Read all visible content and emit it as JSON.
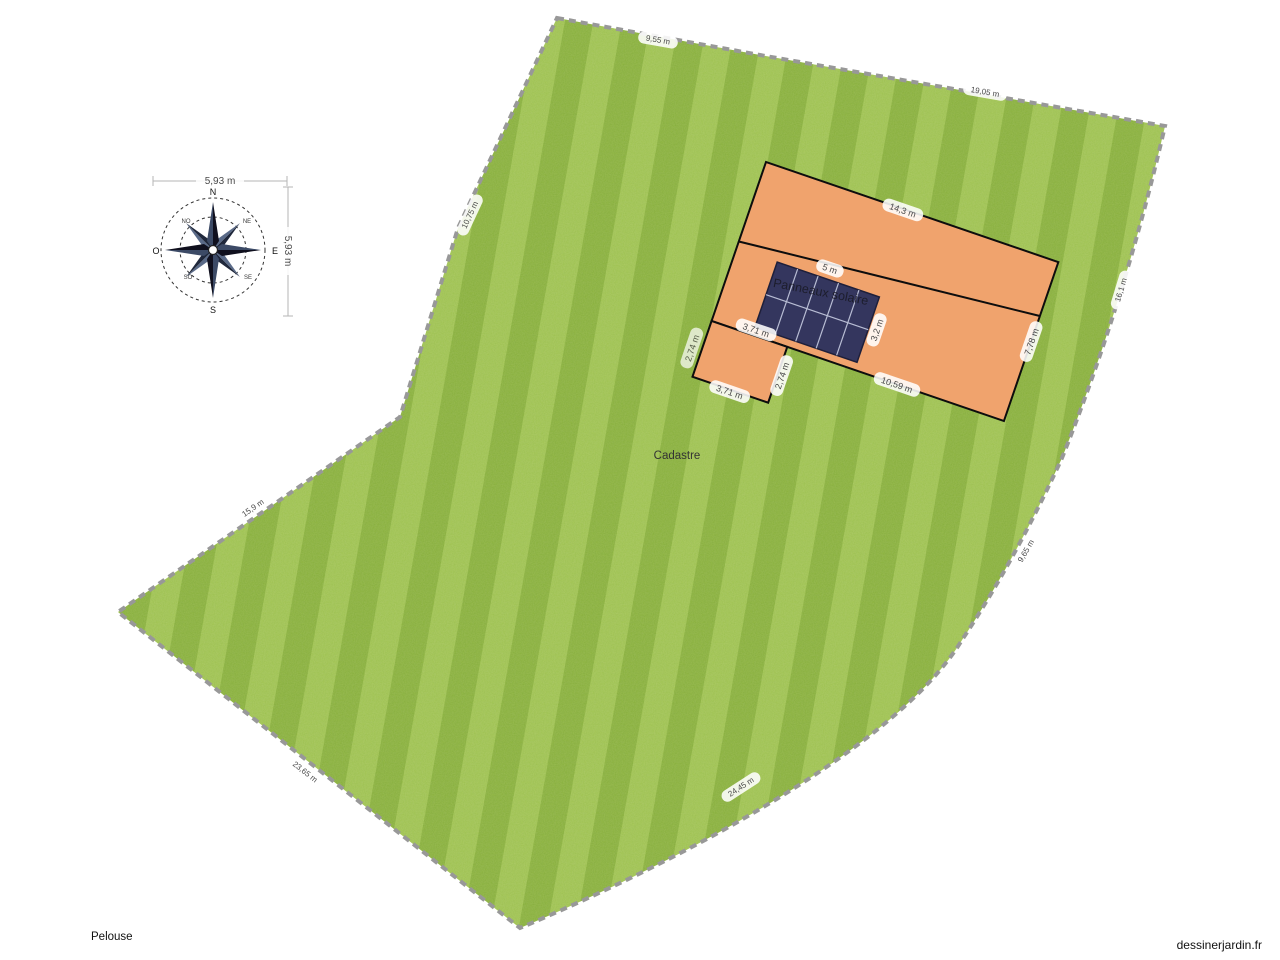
{
  "watermark": {
    "text": "dessinerjardin.fr"
  },
  "labels": {
    "lawn_name": "Pelouse",
    "cadastre": "Cadastre"
  },
  "colors": {
    "lawn_green": "#8eb83c",
    "building_orange": "#f0a36d",
    "panel_navy": "#34365e",
    "panel_grid": "#b8bdd4",
    "outline_black": "#0d0d0d",
    "dashed_border_gray": "#989898",
    "dim_text_gray": "#4a4a4a"
  },
  "compass": {
    "cardinal": {
      "n": "N",
      "s": "S",
      "e": "E",
      "o": "O"
    },
    "intercardinal": {
      "no": "NO",
      "ne": "NE",
      "so": "SO",
      "se": "SE"
    },
    "dim_top": "5,93 m",
    "dim_right": "5,93 m"
  },
  "building": {
    "dims": {
      "top": "14,3 m",
      "bottom": "10,59 m",
      "right": "7,78 m",
      "ext_top": "3,71 m",
      "ext_right": "2,74 m",
      "ext_left": "2,74 m",
      "ext_bottom": "3,71 m"
    }
  },
  "solar": {
    "label": "Panneaux solaire",
    "dim_top": "5 m",
    "dim_side": "3,2 m",
    "columns": 5,
    "rows": 2
  },
  "lawn": {
    "edge_labels": [
      {
        "text": "9,55 m",
        "x": 658,
        "y": 40,
        "rot": 10
      },
      {
        "text": "19,05 m",
        "x": 985,
        "y": 92,
        "rot": 10
      },
      {
        "text": "16,1 m",
        "x": 1121,
        "y": 290,
        "rot": -73
      },
      {
        "text": "9,65 m",
        "x": 1026,
        "y": 551,
        "rot": -60
      },
      {
        "text": "24,45 m",
        "x": 741,
        "y": 787,
        "rot": -33
      },
      {
        "text": "23,65 m",
        "x": 305,
        "y": 772,
        "rot": 38
      },
      {
        "text": "15,9 m",
        "x": 253,
        "y": 508,
        "rot": -35
      },
      {
        "text": "10,75 m",
        "x": 470,
        "y": 215,
        "rot": -65
      }
    ]
  }
}
